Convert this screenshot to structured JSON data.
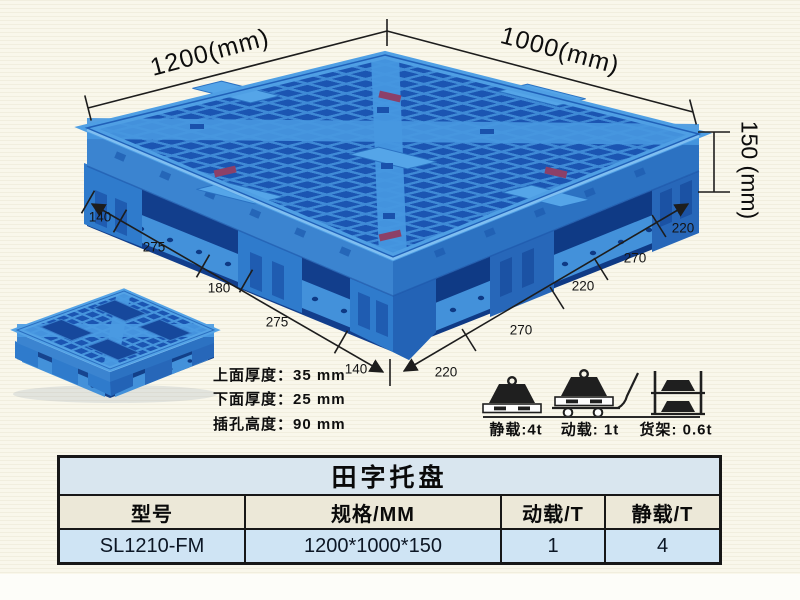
{
  "dimensions": {
    "width_label": "1200(mm)",
    "depth_label": "1000(mm)",
    "height_label": "150 (mm)",
    "left_segments": [
      "140",
      "275",
      "180",
      "275",
      "140"
    ],
    "right_segments": [
      "220",
      "270",
      "220",
      "270",
      "220"
    ]
  },
  "thickness_notes": [
    "上面厚度：35 mm",
    "下面厚度：25 mm",
    "插孔高度：90 mm"
  ],
  "load_ratings": [
    {
      "icon": "static-load-icon",
      "label": "静载:4t"
    },
    {
      "icon": "dynamic-load-icon",
      "label": "动载: 1t"
    },
    {
      "icon": "rack-load-icon",
      "label": "货架: 0.6t"
    }
  ],
  "spec_table": {
    "title": "田字托盘",
    "columns": [
      "型号",
      "规格/MM",
      "动载/T",
      "静载/T"
    ],
    "row": [
      "SL1210-FM",
      "1200*1000*150",
      "1",
      "4"
    ]
  },
  "colors": {
    "pallet_main_blue": "#2f7bcc",
    "pallet_light_blue": "#4f9fe4",
    "pallet_dark_blue": "#1b55b2",
    "background_cream": "#f9f7eb",
    "table_title_bg": "#d9e6ef",
    "table_header_bg": "#ece8d8",
    "table_row_bg": "#cfe4f4",
    "dimension_line": "#1d1d1d"
  }
}
